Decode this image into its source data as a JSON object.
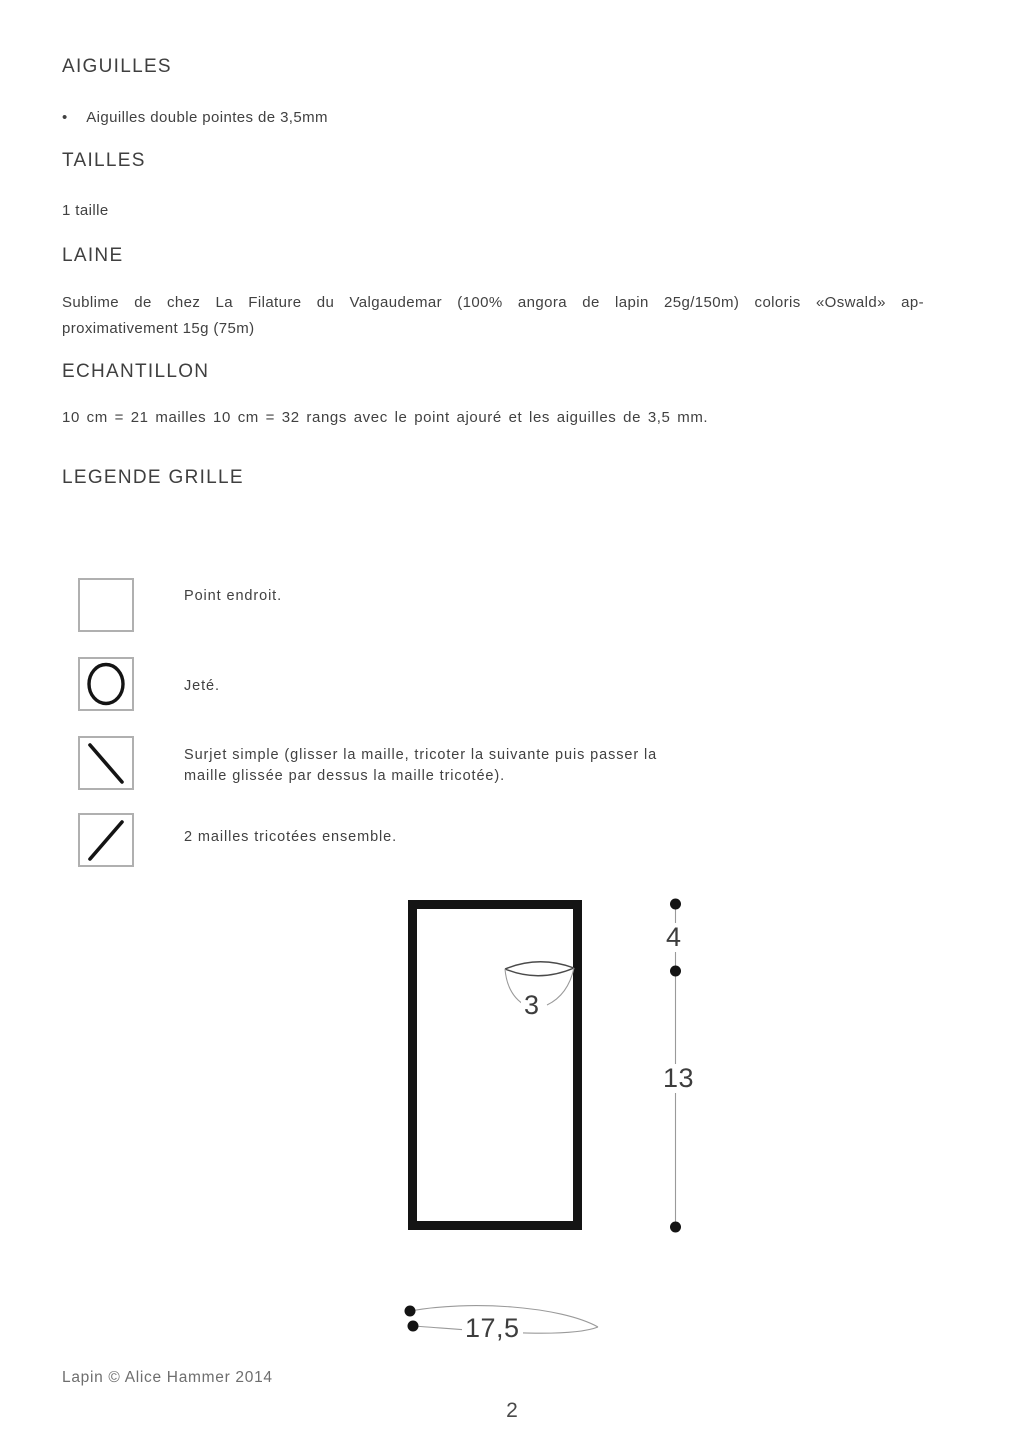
{
  "colors": {
    "text": "#414141",
    "heading": "#3f3f3f",
    "legend_box_border": "#b0b0b0",
    "dimension_line": "#9a9a9a",
    "shape_black": "#141414",
    "footer_text": "#6e6e6e"
  },
  "sections": {
    "aiguilles": {
      "heading": "AIGUILLES",
      "bullet_glyph": "•",
      "bullet_text": "Aiguilles double pointes de 3,5mm"
    },
    "tailles": {
      "heading": "TAILLES",
      "body": "1 taille"
    },
    "laine": {
      "heading": "LAINE",
      "body_line1": "Sublime de chez La Filature du Valgaudemar (100% angora de lapin 25g/150m) coloris «Oswald» ap-",
      "body_line2": "proximativement 15g (75m)"
    },
    "echantillon": {
      "heading": "ECHANTILLON",
      "body": "10 cm = 21 mailles 10 cm = 32 rangs avec le point ajouré et les aiguilles de 3,5 mm."
    },
    "legende": {
      "heading": "LEGENDE GRILLE",
      "items": [
        {
          "symbol": "knit-stitch-empty-square",
          "label": "Point endroit."
        },
        {
          "symbol": "yarn-over-circle",
          "label": "Jeté."
        },
        {
          "symbol": "ssk-backslash",
          "label_line1": "Surjet simple (glisser la maille, tricoter la suivante puis passer la",
          "label_line2": "maille glissée par dessus la maille tricotée)."
        },
        {
          "symbol": "k2tog-slash",
          "label": "2 mailles tricotées ensemble."
        }
      ]
    }
  },
  "schematic": {
    "neck_width_label": "3",
    "top_height_label": "4",
    "side_height_label": "13",
    "bottom_width_label": "17,5"
  },
  "footer": {
    "credit": "Lapin © Alice Hammer 2014",
    "page_number": "2"
  }
}
